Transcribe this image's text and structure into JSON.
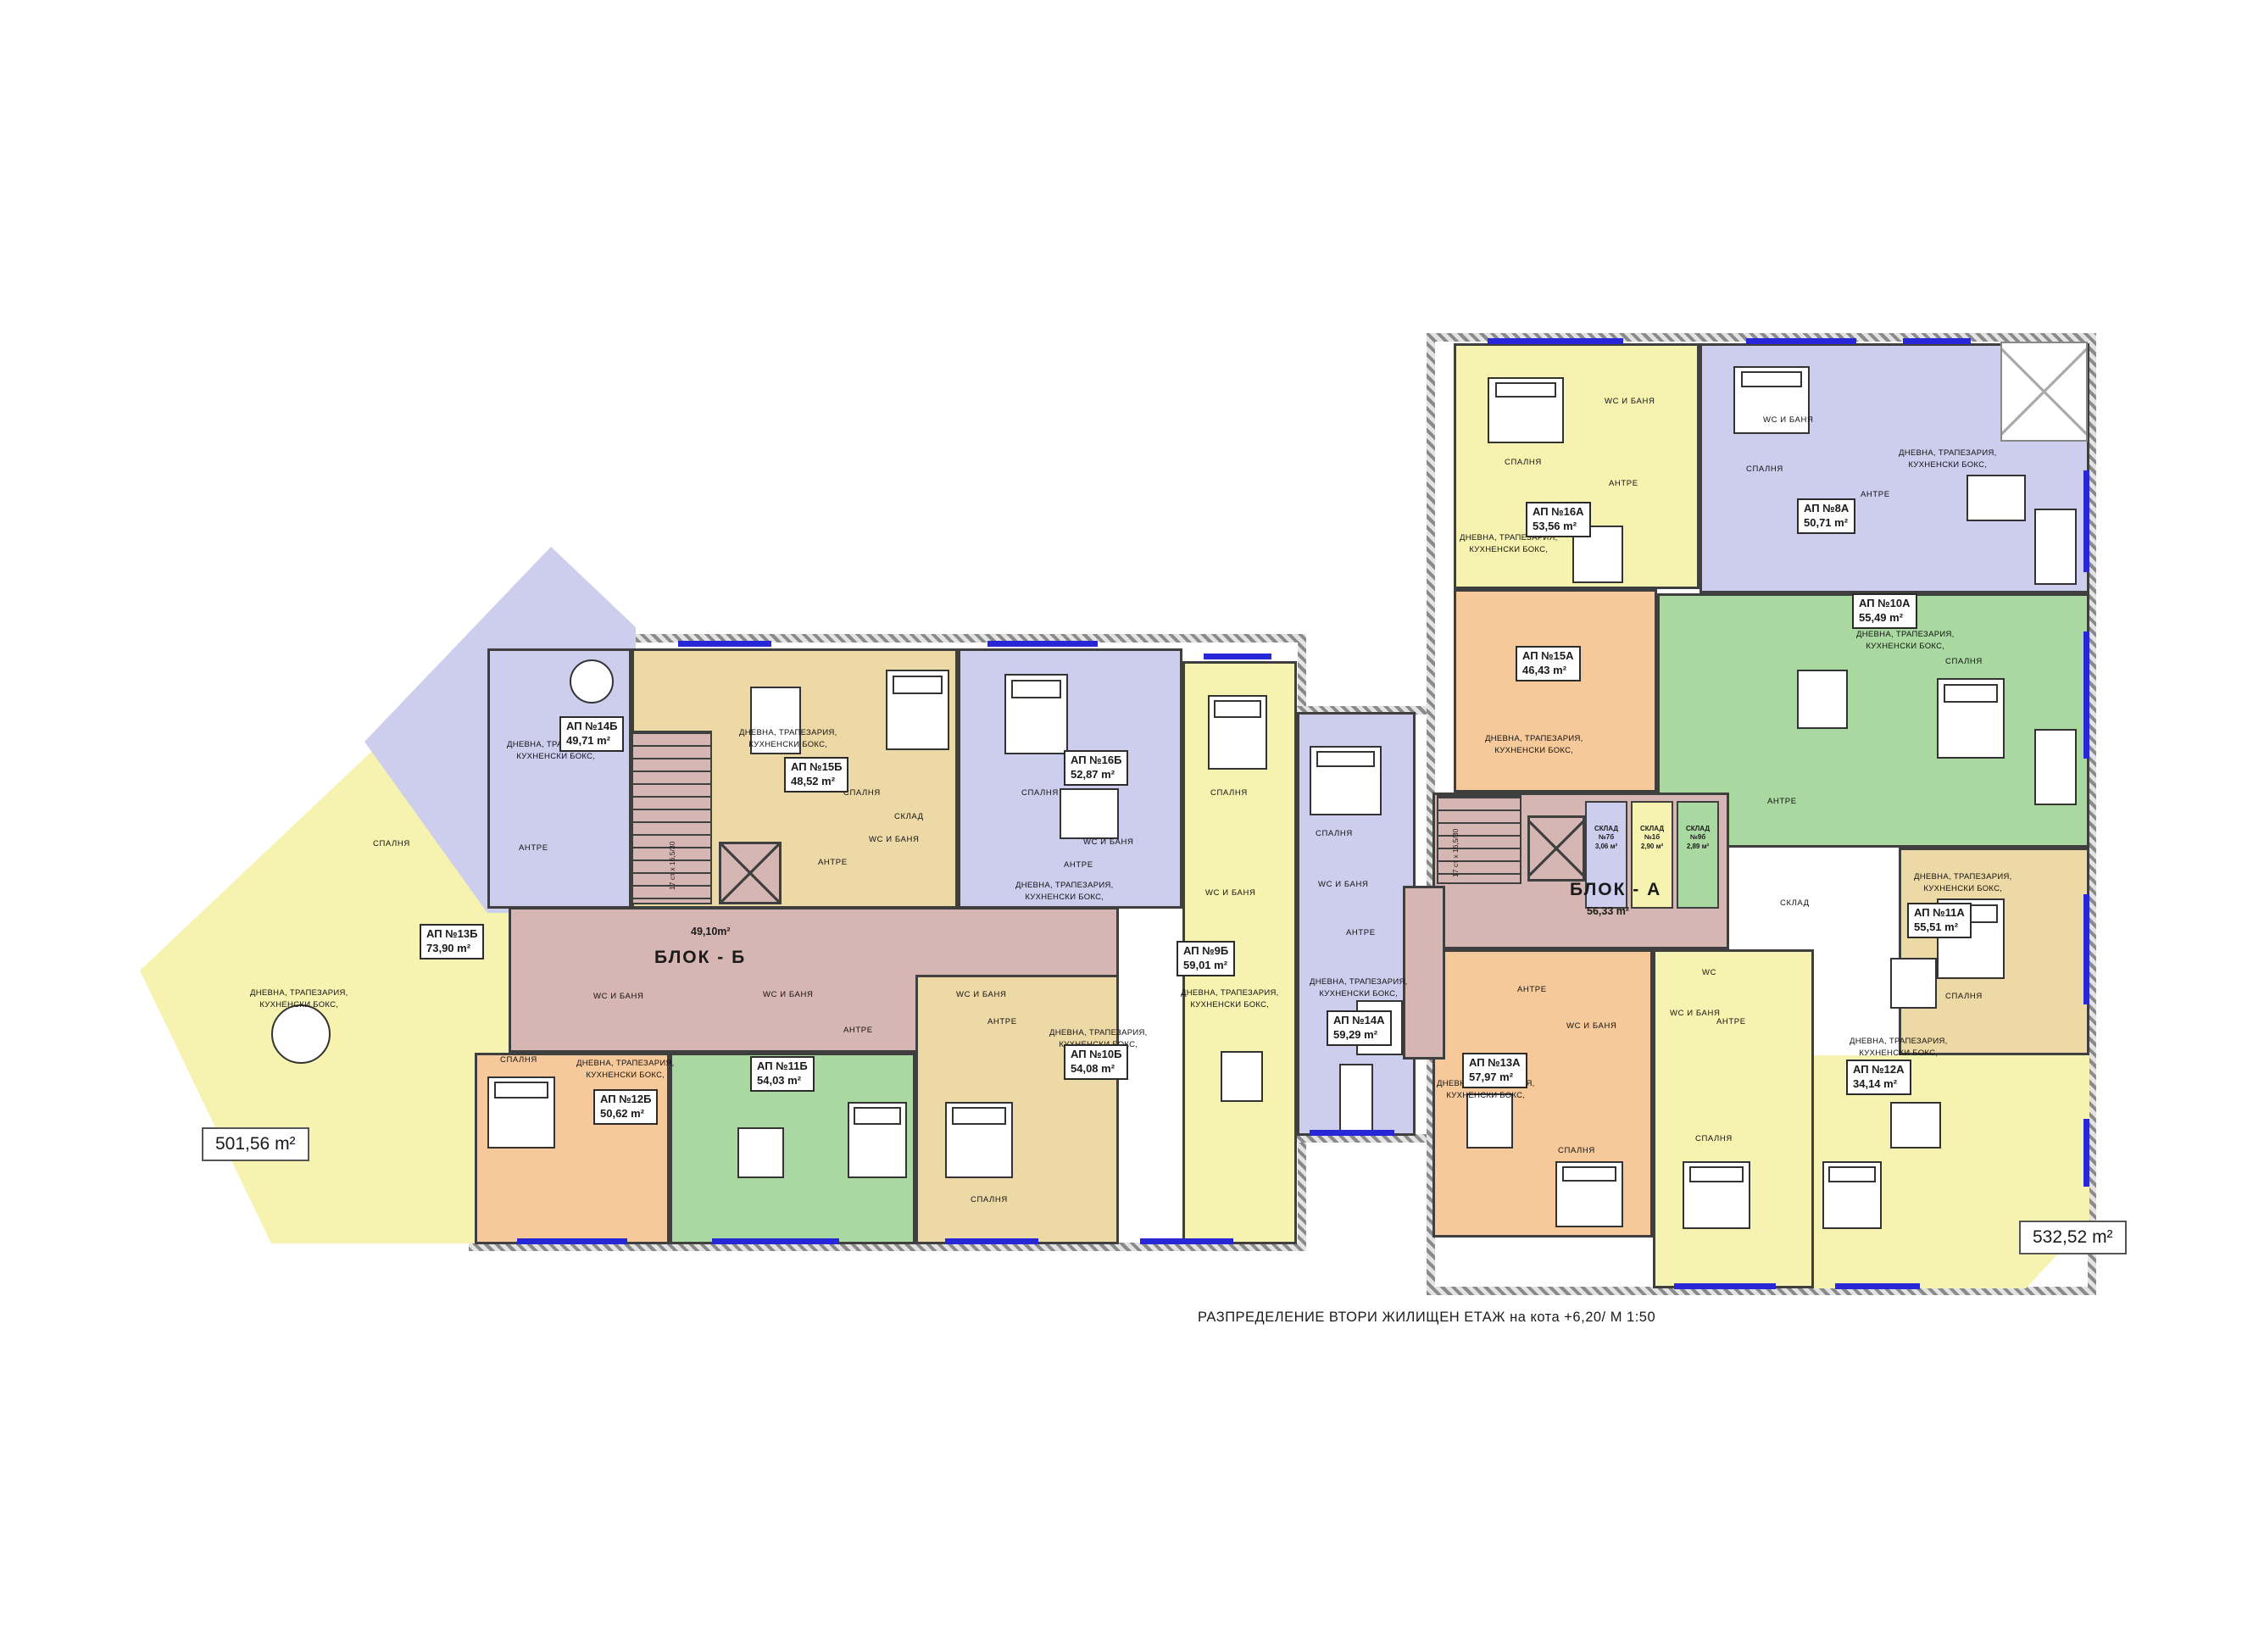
{
  "title": {
    "caption": "РАЗПРЕДЕЛЕНИЕ ВТОРИ ЖИЛИЩЕН ЕТАЖ на кота +6,20/   М 1:50"
  },
  "totals": {
    "left": "501,56 m²",
    "right": "532,52 m²"
  },
  "corridors": {
    "block_b": {
      "name": "БЛОК - Б",
      "area": "49,10m²",
      "stairs_note": "17 ст х 16,5/30"
    },
    "block_a": {
      "name": "БЛОК - А",
      "area": "56,33 m²",
      "stairs_note": "17 ст х 16,5/30"
    }
  },
  "storages": [
    {
      "label": "СКЛАД №7б",
      "area": "3,06 м²"
    },
    {
      "label": "СКЛАД №1б",
      "area": "2,90 м²"
    },
    {
      "label": "СКЛАД №9б",
      "area": "2,89 м²"
    }
  ],
  "rooms": {
    "bedroom": "СПАЛНЯ",
    "entry": "АНТРЕ",
    "bath": "WC И БАНЯ",
    "wc": "WC",
    "storage": "СКЛАД",
    "living_1": "ДНЕВНА, ТРАПЕЗАРИЯ,",
    "living_2": "КУХНЕНСКИ БОКС,"
  },
  "apartments": {
    "b9": {
      "label": "АП №9Б",
      "area": "59,01 m²"
    },
    "b10": {
      "label": "АП №10Б",
      "area": "54,08 m²"
    },
    "b11": {
      "label": "АП №11Б",
      "area": "54,03 m²"
    },
    "b12": {
      "label": "АП №12Б",
      "area": "50,62 m²"
    },
    "b13": {
      "label": "АП №13Б",
      "area": "73,90 m²"
    },
    "b14": {
      "label": "АП №14Б",
      "area": "49,71 m²"
    },
    "b15": {
      "label": "АП №15Б",
      "area": "48,52 m²"
    },
    "b16": {
      "label": "АП №16Б",
      "area": "52,87 m²"
    },
    "a8": {
      "label": "АП №8А",
      "area": "50,71 m²"
    },
    "a10": {
      "label": "АП №10А",
      "area": "55,49 m²"
    },
    "a11": {
      "label": "АП №11А",
      "area": "55,51 m²"
    },
    "a12": {
      "label": "АП №12А",
      "area": "34,14 m²"
    },
    "a13": {
      "label": "АП №13А",
      "area": "57,97 m²"
    },
    "a14": {
      "label": "АП №14А",
      "area": "59,29 m²"
    },
    "a15": {
      "label": "АП №15А",
      "area": "46,43 m²"
    },
    "a16": {
      "label": "АП №16А",
      "area": "53,56 m²"
    }
  },
  "colors": {
    "yellow": "#f6f3b0",
    "lavender": "#cdcdee",
    "tan": "#ecd9a6",
    "orange": "#f6c99b",
    "green": "#a9d8a1",
    "corridor_pink": "#d6b6b3",
    "window_blue": "#2727d8"
  }
}
